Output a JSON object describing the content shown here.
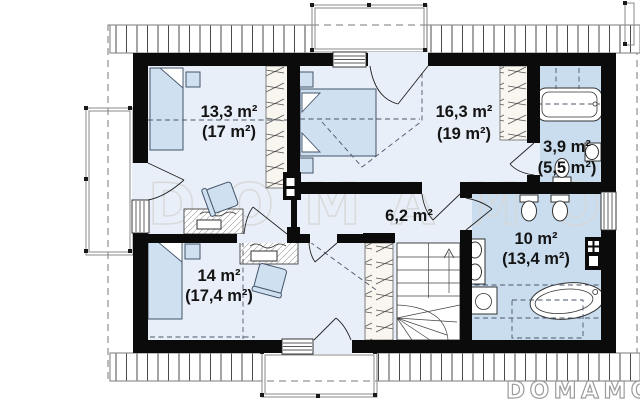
{
  "page": {
    "type": "floor-plan",
    "description": "attic storey plan"
  },
  "watermark": {
    "center": "DOMAMO",
    "corner": "DOMAMO"
  },
  "rooms": [
    {
      "name": "bedroom-top-left",
      "area": "13,3 m²",
      "area_gross": "(17 m²)"
    },
    {
      "name": "bedroom-top-middle",
      "area": "16,3 m²",
      "area_gross": "(19 m²)"
    },
    {
      "name": "bathroom-small",
      "area": "3,9 m²",
      "area_gross": "(5,5 m²)"
    },
    {
      "name": "hallway",
      "area": "6,2 m²",
      "area_gross": ""
    },
    {
      "name": "bedroom-bottom-left",
      "area": "14 m²",
      "area_gross": "(17,4 m²)"
    },
    {
      "name": "bathroom-large",
      "area": "10 m²",
      "area_gross": "(13,4 m²)"
    }
  ],
  "colors": {
    "wall": "#0b0b0b",
    "room_floor": "#e9eff8",
    "bathroom_floor": "#c9ddef",
    "furniture_fill": "#cfe0f1",
    "watermark_center": "#d6d6d6",
    "watermark_corner": "#9b9b9b"
  }
}
